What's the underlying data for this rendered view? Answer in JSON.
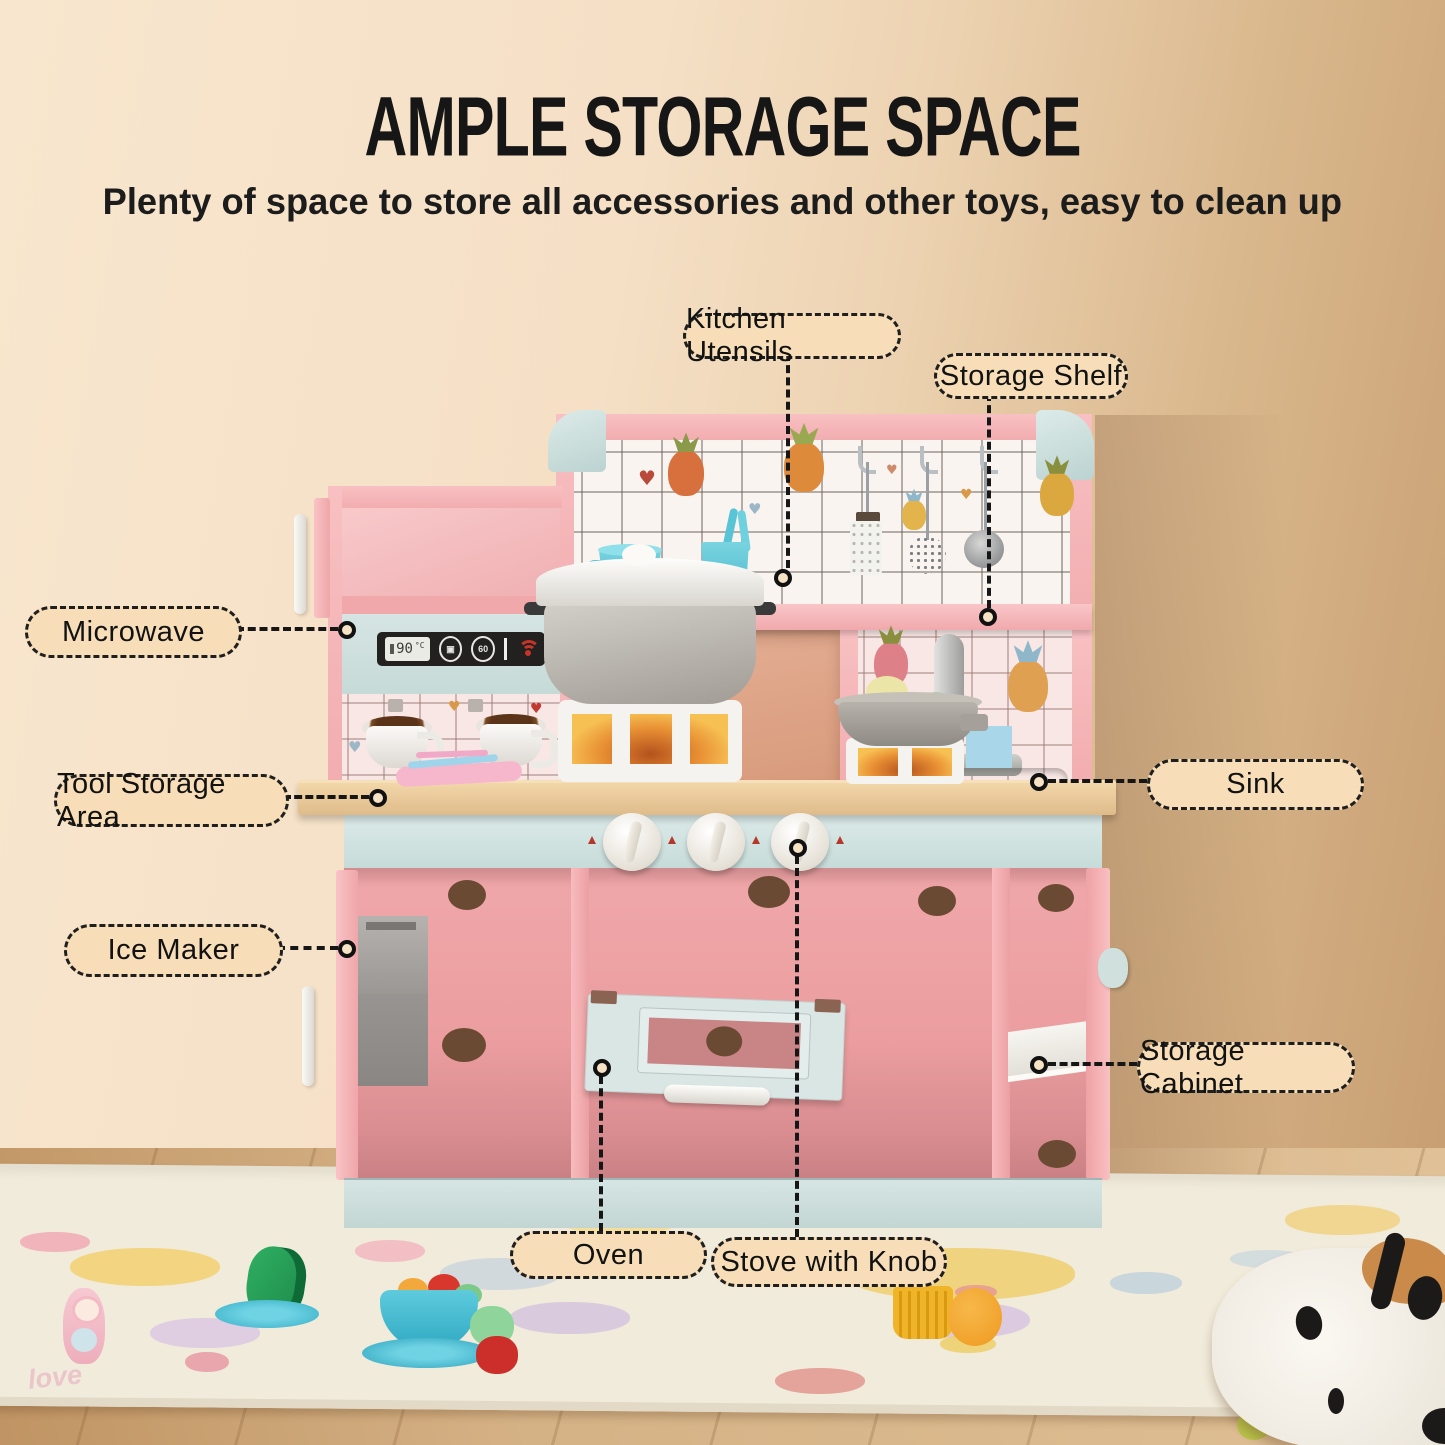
{
  "title": "AMPLE STORAGE SPACE",
  "subtitle": "Plenty of space to store all accessories and other toys, easy to clean up",
  "callouts": {
    "kitchen_utensils": {
      "label": "Kitchen Utensils"
    },
    "storage_shelf": {
      "label": "Storage Shelf"
    },
    "microwave": {
      "label": "Microwave"
    },
    "tool_storage_area": {
      "label": "Tool Storage Area"
    },
    "sink": {
      "label": "Sink"
    },
    "ice_maker": {
      "label": "Ice Maker"
    },
    "storage_cabinet": {
      "label": "Storage Cabinet"
    },
    "oven": {
      "label": "Oven"
    },
    "stove_with_knob": {
      "label": "Stove with Knob"
    }
  },
  "microwave_panel": {
    "display_value": "90",
    "display_unit": "°C",
    "timer_label": "60"
  },
  "rug": {
    "text": "love"
  },
  "colors": {
    "wall": "#f5e0c6",
    "wall_shadow": "#c79e71",
    "pink": "#f5b5b8",
    "pink_interior": "#efa3a6",
    "mint": "#cfe0df",
    "wood_counter": "#e3c192",
    "label_bg": "#f7deb8",
    "label_border": "#1f1f1f",
    "title_color": "#161616",
    "rug_color": "#f1ebdb",
    "floor_wood": "#d5b286",
    "blue_cup": "#5ec6d8",
    "red_icon": "#c63428"
  }
}
